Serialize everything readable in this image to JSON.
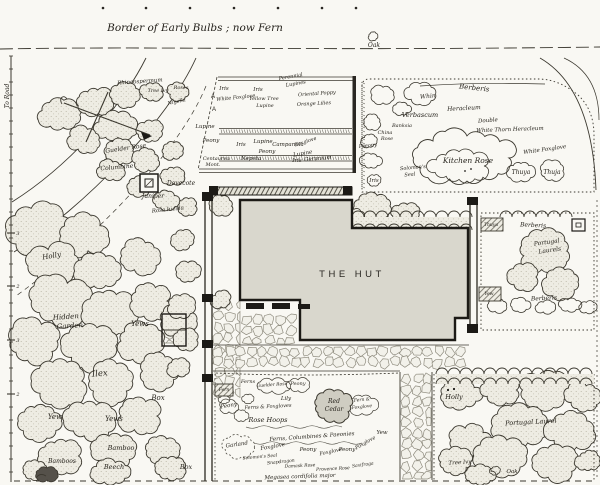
{
  "title": {
    "text": "Border of Early Bulbs ; now Fern"
  },
  "building": {
    "label": "THE HUT"
  },
  "scale": {
    "road_label": "To Road",
    "ticks": [
      "3",
      "2",
      "3",
      "2"
    ],
    "tick_y": [
      233,
      286,
      340,
      394
    ]
  },
  "colors": {
    "paper": "#f9f8f3",
    "ink": "#26231c",
    "building_fill": "#d9d7cd",
    "stone_fill": "#f2f1ea",
    "shrub_fill": "#eeece3",
    "cedar_fill": "#cfcdc2"
  },
  "plan": {
    "labels": [
      {
        "t": "Oak",
        "x": 374,
        "y": 47,
        "s": 6,
        "n": "oak-top-label"
      },
      {
        "t": "Rhincospermum",
        "x": 140,
        "y": 83,
        "s": 5.5,
        "r": -4
      },
      {
        "t": "Tree Ivy",
        "x": 158,
        "y": 92,
        "s": 5
      },
      {
        "t": "Roses",
        "x": 181,
        "y": 89,
        "s": 5
      },
      {
        "t": "Guelder Rose",
        "x": 126,
        "y": 150,
        "s": 6,
        "r": -8
      },
      {
        "t": "Columbine",
        "x": 117,
        "y": 169,
        "s": 6,
        "r": -5
      },
      {
        "t": "Dovecote",
        "x": 181,
        "y": 185,
        "s": 6,
        "n": "dovecote-label"
      },
      {
        "t": "Juniper",
        "x": 153,
        "y": 198,
        "s": 6
      },
      {
        "t": "Rosa lucida",
        "x": 168,
        "y": 211,
        "s": 5.5,
        "r": -6
      },
      {
        "t": "Holly",
        "x": 52,
        "y": 258,
        "s": 7,
        "r": -10
      },
      {
        "t": "Hidden",
        "x": 66,
        "y": 319,
        "s": 7,
        "r": -4,
        "n": "hidden-garden-label"
      },
      {
        "t": "Garden",
        "x": 70,
        "y": 328,
        "s": 7,
        "r": -4,
        "n": "hidden-garden-label"
      },
      {
        "t": "Yews",
        "x": 140,
        "y": 326,
        "s": 7
      },
      {
        "t": "Ilex",
        "x": 100,
        "y": 376,
        "s": 8.5,
        "r": -5
      },
      {
        "t": "Box",
        "x": 158,
        "y": 400,
        "s": 7
      },
      {
        "t": "Yew",
        "x": 55,
        "y": 419,
        "s": 7
      },
      {
        "t": "Yews",
        "x": 114,
        "y": 421,
        "s": 7
      },
      {
        "t": "Bamboo",
        "x": 121,
        "y": 450,
        "s": 6.5
      },
      {
        "t": "Bamboos",
        "x": 62,
        "y": 463,
        "s": 6
      },
      {
        "t": "Beech",
        "x": 114,
        "y": 469,
        "s": 6.5
      },
      {
        "t": "Box",
        "x": 186,
        "y": 469,
        "s": 6.5
      },
      {
        "t": "A",
        "x": 213,
        "y": 98,
        "s": 6,
        "c": "p"
      },
      {
        "t": "A",
        "x": 214,
        "y": 111,
        "s": 6,
        "c": "p"
      },
      {
        "t": "Iris",
        "x": 224,
        "y": 90,
        "s": 5.5
      },
      {
        "t": "White Foxglove",
        "x": 236,
        "y": 99,
        "s": 5,
        "r": -6
      },
      {
        "t": "Iris",
        "x": 258,
        "y": 91,
        "s": 5.5
      },
      {
        "t": "Yellow Tree",
        "x": 264,
        "y": 100,
        "s": 5
      },
      {
        "t": "Lupine",
        "x": 265,
        "y": 107,
        "s": 5
      },
      {
        "t": "Perennial",
        "x": 291,
        "y": 78,
        "s": 5,
        "r": -10
      },
      {
        "t": "Lupines",
        "x": 296,
        "y": 85,
        "s": 5,
        "r": -10
      },
      {
        "t": "Oriental Poppy",
        "x": 317,
        "y": 95,
        "s": 5,
        "r": -4
      },
      {
        "t": "Orange Lilies",
        "x": 314,
        "y": 105,
        "s": 5,
        "r": -3
      },
      {
        "t": "Nigella",
        "x": 177,
        "y": 103,
        "s": 5,
        "r": -12
      },
      {
        "t": "Lupine",
        "x": 205,
        "y": 128,
        "s": 5.5
      },
      {
        "t": "Peony",
        "x": 211,
        "y": 142,
        "s": 5.5
      },
      {
        "t": "Iris",
        "x": 241,
        "y": 146,
        "s": 5.5
      },
      {
        "t": "Lupine",
        "x": 263,
        "y": 143,
        "s": 5.5
      },
      {
        "t": "Campanula",
        "x": 288,
        "y": 146,
        "s": 5.5
      },
      {
        "t": "Foxglove",
        "x": 306,
        "y": 143,
        "s": 5,
        "r": -18
      },
      {
        "t": "Peony",
        "x": 267,
        "y": 153,
        "s": 5.5
      },
      {
        "t": "Lupine",
        "x": 303,
        "y": 155,
        "s": 5.5,
        "r": -10
      },
      {
        "t": "Nepeta",
        "x": 251,
        "y": 160,
        "s": 5.5
      },
      {
        "t": "Iris",
        "x": 297,
        "y": 162,
        "s": 5.5
      },
      {
        "t": "Geranium",
        "x": 318,
        "y": 160,
        "s": 5.5,
        "r": -5
      },
      {
        "t": "Centaurea",
        "x": 216,
        "y": 160,
        "s": 5
      },
      {
        "t": "Mont.",
        "x": 213,
        "y": 166,
        "s": 5
      },
      {
        "t": "Berberis",
        "x": 474,
        "y": 90,
        "s": 7,
        "r": 6
      },
      {
        "t": "Whin",
        "x": 428,
        "y": 98,
        "s": 6,
        "r": -5
      },
      {
        "t": "Verbascum",
        "x": 420,
        "y": 117,
        "s": 6.5
      },
      {
        "t": "Heracleum",
        "x": 464,
        "y": 110,
        "s": 6,
        "r": -3
      },
      {
        "t": "Double",
        "x": 488,
        "y": 122,
        "s": 5.5,
        "r": -4
      },
      {
        "t": "White Thorn Heracleum",
        "x": 510,
        "y": 131,
        "s": 5.5,
        "r": -2
      },
      {
        "t": "Banksia",
        "x": 402,
        "y": 127,
        "s": 5
      },
      {
        "t": "China",
        "x": 385,
        "y": 134,
        "s": 5
      },
      {
        "t": "Rose",
        "x": 387,
        "y": 140,
        "s": 5
      },
      {
        "t": "Paeony",
        "x": 368,
        "y": 147,
        "s": 5,
        "r": -6
      },
      {
        "t": "Kitchen Rose",
        "x": 468,
        "y": 163,
        "s": 7.5,
        "n": "kitchen-rose-label"
      },
      {
        "t": "White Foxglove",
        "x": 545,
        "y": 151,
        "s": 5.5,
        "r": -8
      },
      {
        "t": "Thuya",
        "x": 521,
        "y": 174,
        "s": 6
      },
      {
        "t": "Thuja",
        "x": 552,
        "y": 174,
        "s": 6
      },
      {
        "t": "Iris",
        "x": 374,
        "y": 182,
        "s": 5.5
      },
      {
        "t": "Solomon's",
        "x": 413,
        "y": 169,
        "s": 5,
        "r": -5
      },
      {
        "t": "Seal",
        "x": 410,
        "y": 176,
        "s": 5,
        "r": -5
      },
      {
        "t": "Holly",
        "x": 454,
        "y": 399,
        "s": 6.5
      },
      {
        "t": "Yew",
        "x": 382,
        "y": 434,
        "s": 5.5
      },
      {
        "t": "Berberis",
        "x": 533,
        "y": 227,
        "s": 6,
        "r": 3
      },
      {
        "t": "Portugal",
        "x": 547,
        "y": 244,
        "s": 6,
        "r": -8
      },
      {
        "t": "Laurels",
        "x": 550,
        "y": 252,
        "s": 6,
        "r": -8
      },
      {
        "t": "Berberis",
        "x": 544,
        "y": 300,
        "s": 6,
        "r": -3
      },
      {
        "t": "Thuya",
        "x": 491,
        "y": 226,
        "s": 4.5
      },
      {
        "t": "Yew",
        "x": 489,
        "y": 295,
        "s": 4.5
      },
      {
        "t": "Fern",
        "x": 224,
        "y": 391,
        "s": 4.5
      },
      {
        "t": "Ferns",
        "x": 248,
        "y": 383,
        "s": 5
      },
      {
        "t": "Guelder Rose",
        "x": 272,
        "y": 386,
        "s": 4.5,
        "r": -4
      },
      {
        "t": "Peony",
        "x": 298,
        "y": 385,
        "s": 5
      },
      {
        "t": "Lily",
        "x": 286,
        "y": 400,
        "s": 5.5
      },
      {
        "t": "Ferns & Foxgloves",
        "x": 268,
        "y": 408,
        "s": 5,
        "r": -3
      },
      {
        "t": "Peony",
        "x": 229,
        "y": 407,
        "s": 5.5,
        "r": -10
      },
      {
        "t": "Red",
        "x": 334,
        "y": 403,
        "s": 6,
        "n": "red-cedar-label"
      },
      {
        "t": "Cedar",
        "x": 334,
        "y": 411,
        "s": 6,
        "n": "red-cedar-label"
      },
      {
        "t": "Fern &",
        "x": 362,
        "y": 401,
        "s": 4.5,
        "r": -6
      },
      {
        "t": "Foxglove",
        "x": 362,
        "y": 408,
        "s": 4.5,
        "r": -6
      },
      {
        "t": "Rose Hoops",
        "x": 268,
        "y": 422,
        "s": 6.5
      },
      {
        "t": "Ferns, Columbines & Paeonies",
        "x": 312,
        "y": 438,
        "s": 5.5,
        "r": -4
      },
      {
        "t": "Garland",
        "x": 237,
        "y": 446,
        "s": 5.5,
        "r": -8
      },
      {
        "t": "Foxglove",
        "x": 273,
        "y": 448,
        "s": 5.5,
        "r": -10
      },
      {
        "t": "Peony",
        "x": 308,
        "y": 451,
        "s": 5.5
      },
      {
        "t": "Foxglove",
        "x": 331,
        "y": 453,
        "s": 5,
        "r": -12
      },
      {
        "t": "Peony",
        "x": 347,
        "y": 451,
        "s": 5.5
      },
      {
        "t": "Foxglove",
        "x": 366,
        "y": 444,
        "s": 5,
        "r": -30
      },
      {
        "t": "Solomon's Seal",
        "x": 260,
        "y": 458,
        "s": 4.5,
        "r": -5
      },
      {
        "t": "Snapdragon",
        "x": 281,
        "y": 463,
        "s": 4.5,
        "r": -6
      },
      {
        "t": "Damask Rose",
        "x": 300,
        "y": 467,
        "s": 4.5,
        "r": -3
      },
      {
        "t": "Provence Rose",
        "x": 333,
        "y": 470,
        "s": 4.5,
        "r": -3
      },
      {
        "t": "Saxifraga",
        "x": 363,
        "y": 466,
        "s": 4.5,
        "r": -8
      },
      {
        "t": "Megasea cordifolia major",
        "x": 300,
        "y": 478,
        "s": 5.5,
        "r": -2
      },
      {
        "t": "Portugal Laurel",
        "x": 531,
        "y": 424,
        "s": 6.5,
        "r": -3
      },
      {
        "t": "Tree Ivy",
        "x": 460,
        "y": 464,
        "s": 5.5,
        "r": -4
      },
      {
        "t": "Oak",
        "x": 512,
        "y": 473,
        "s": 5.5,
        "n": "oak-bottom-label"
      }
    ]
  }
}
